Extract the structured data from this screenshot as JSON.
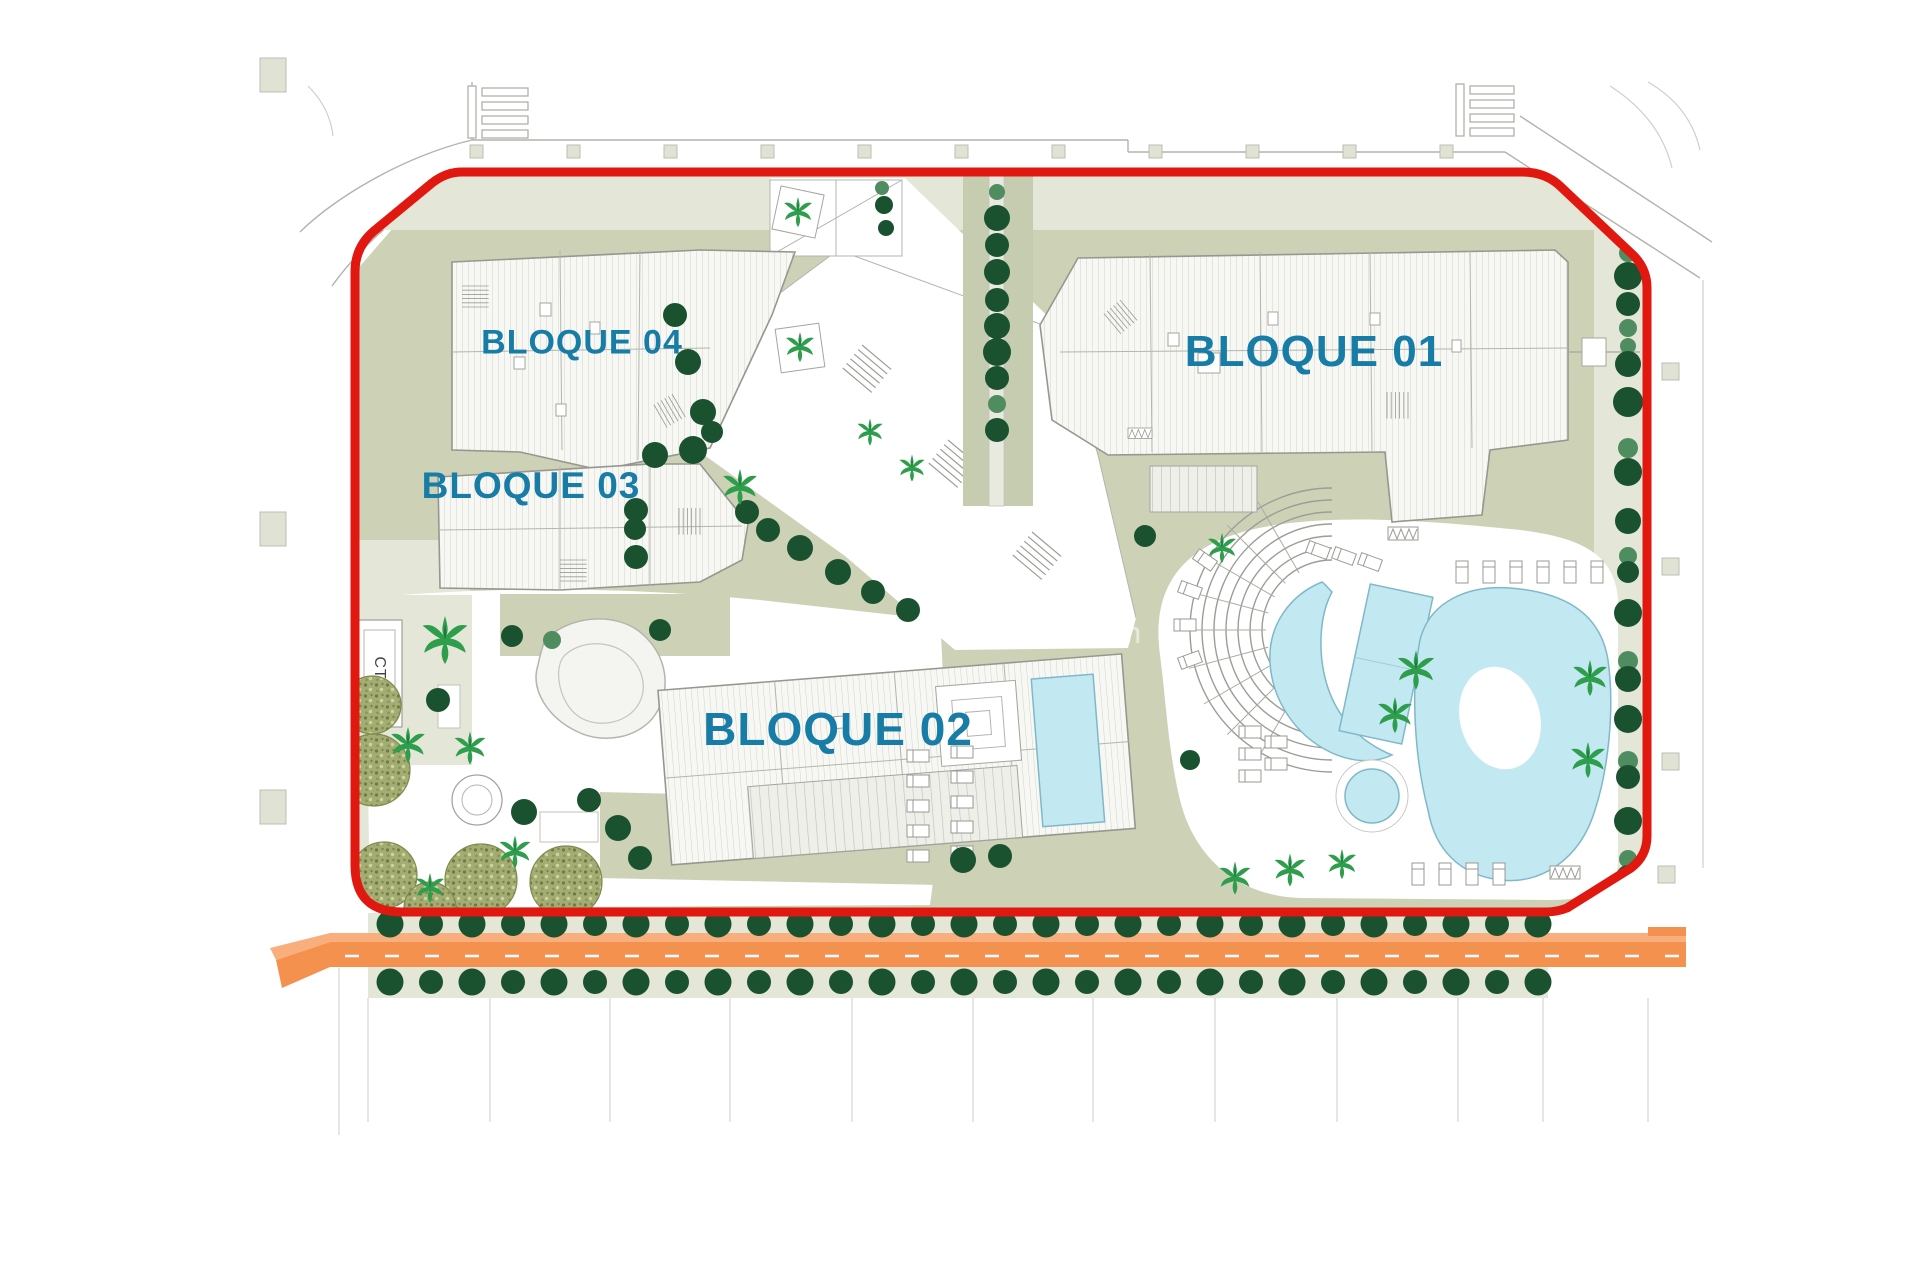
{
  "plan": {
    "labels": {
      "bloque01": "BLOQUE 01",
      "bloque02": "BLOQUE 02",
      "bloque03": "BLOQUE 03",
      "bloque04": "BLOQUE 04"
    },
    "transformer_label": "CT",
    "watermark": "www.··········sol.com"
  },
  "colors": {
    "label_blue": "#177CA6",
    "boundary_red": "#E0180F",
    "road_orange": "#F5914F",
    "road_orange_light": "#F9AF7D",
    "site_olive": "#CDD2B7",
    "site_olive_light": "#E4E7D8",
    "pool_blue": "#C2E8F2",
    "pool_edge": "#7FB8C8",
    "tree_dark": "#1A5230",
    "tree_medium": "#4F8C5F",
    "palm_green": "#2E9E4C",
    "olive_tree": "#A3AC72",
    "roof_white": "#F7F7F4",
    "line_gray": "#A9A9A3"
  }
}
